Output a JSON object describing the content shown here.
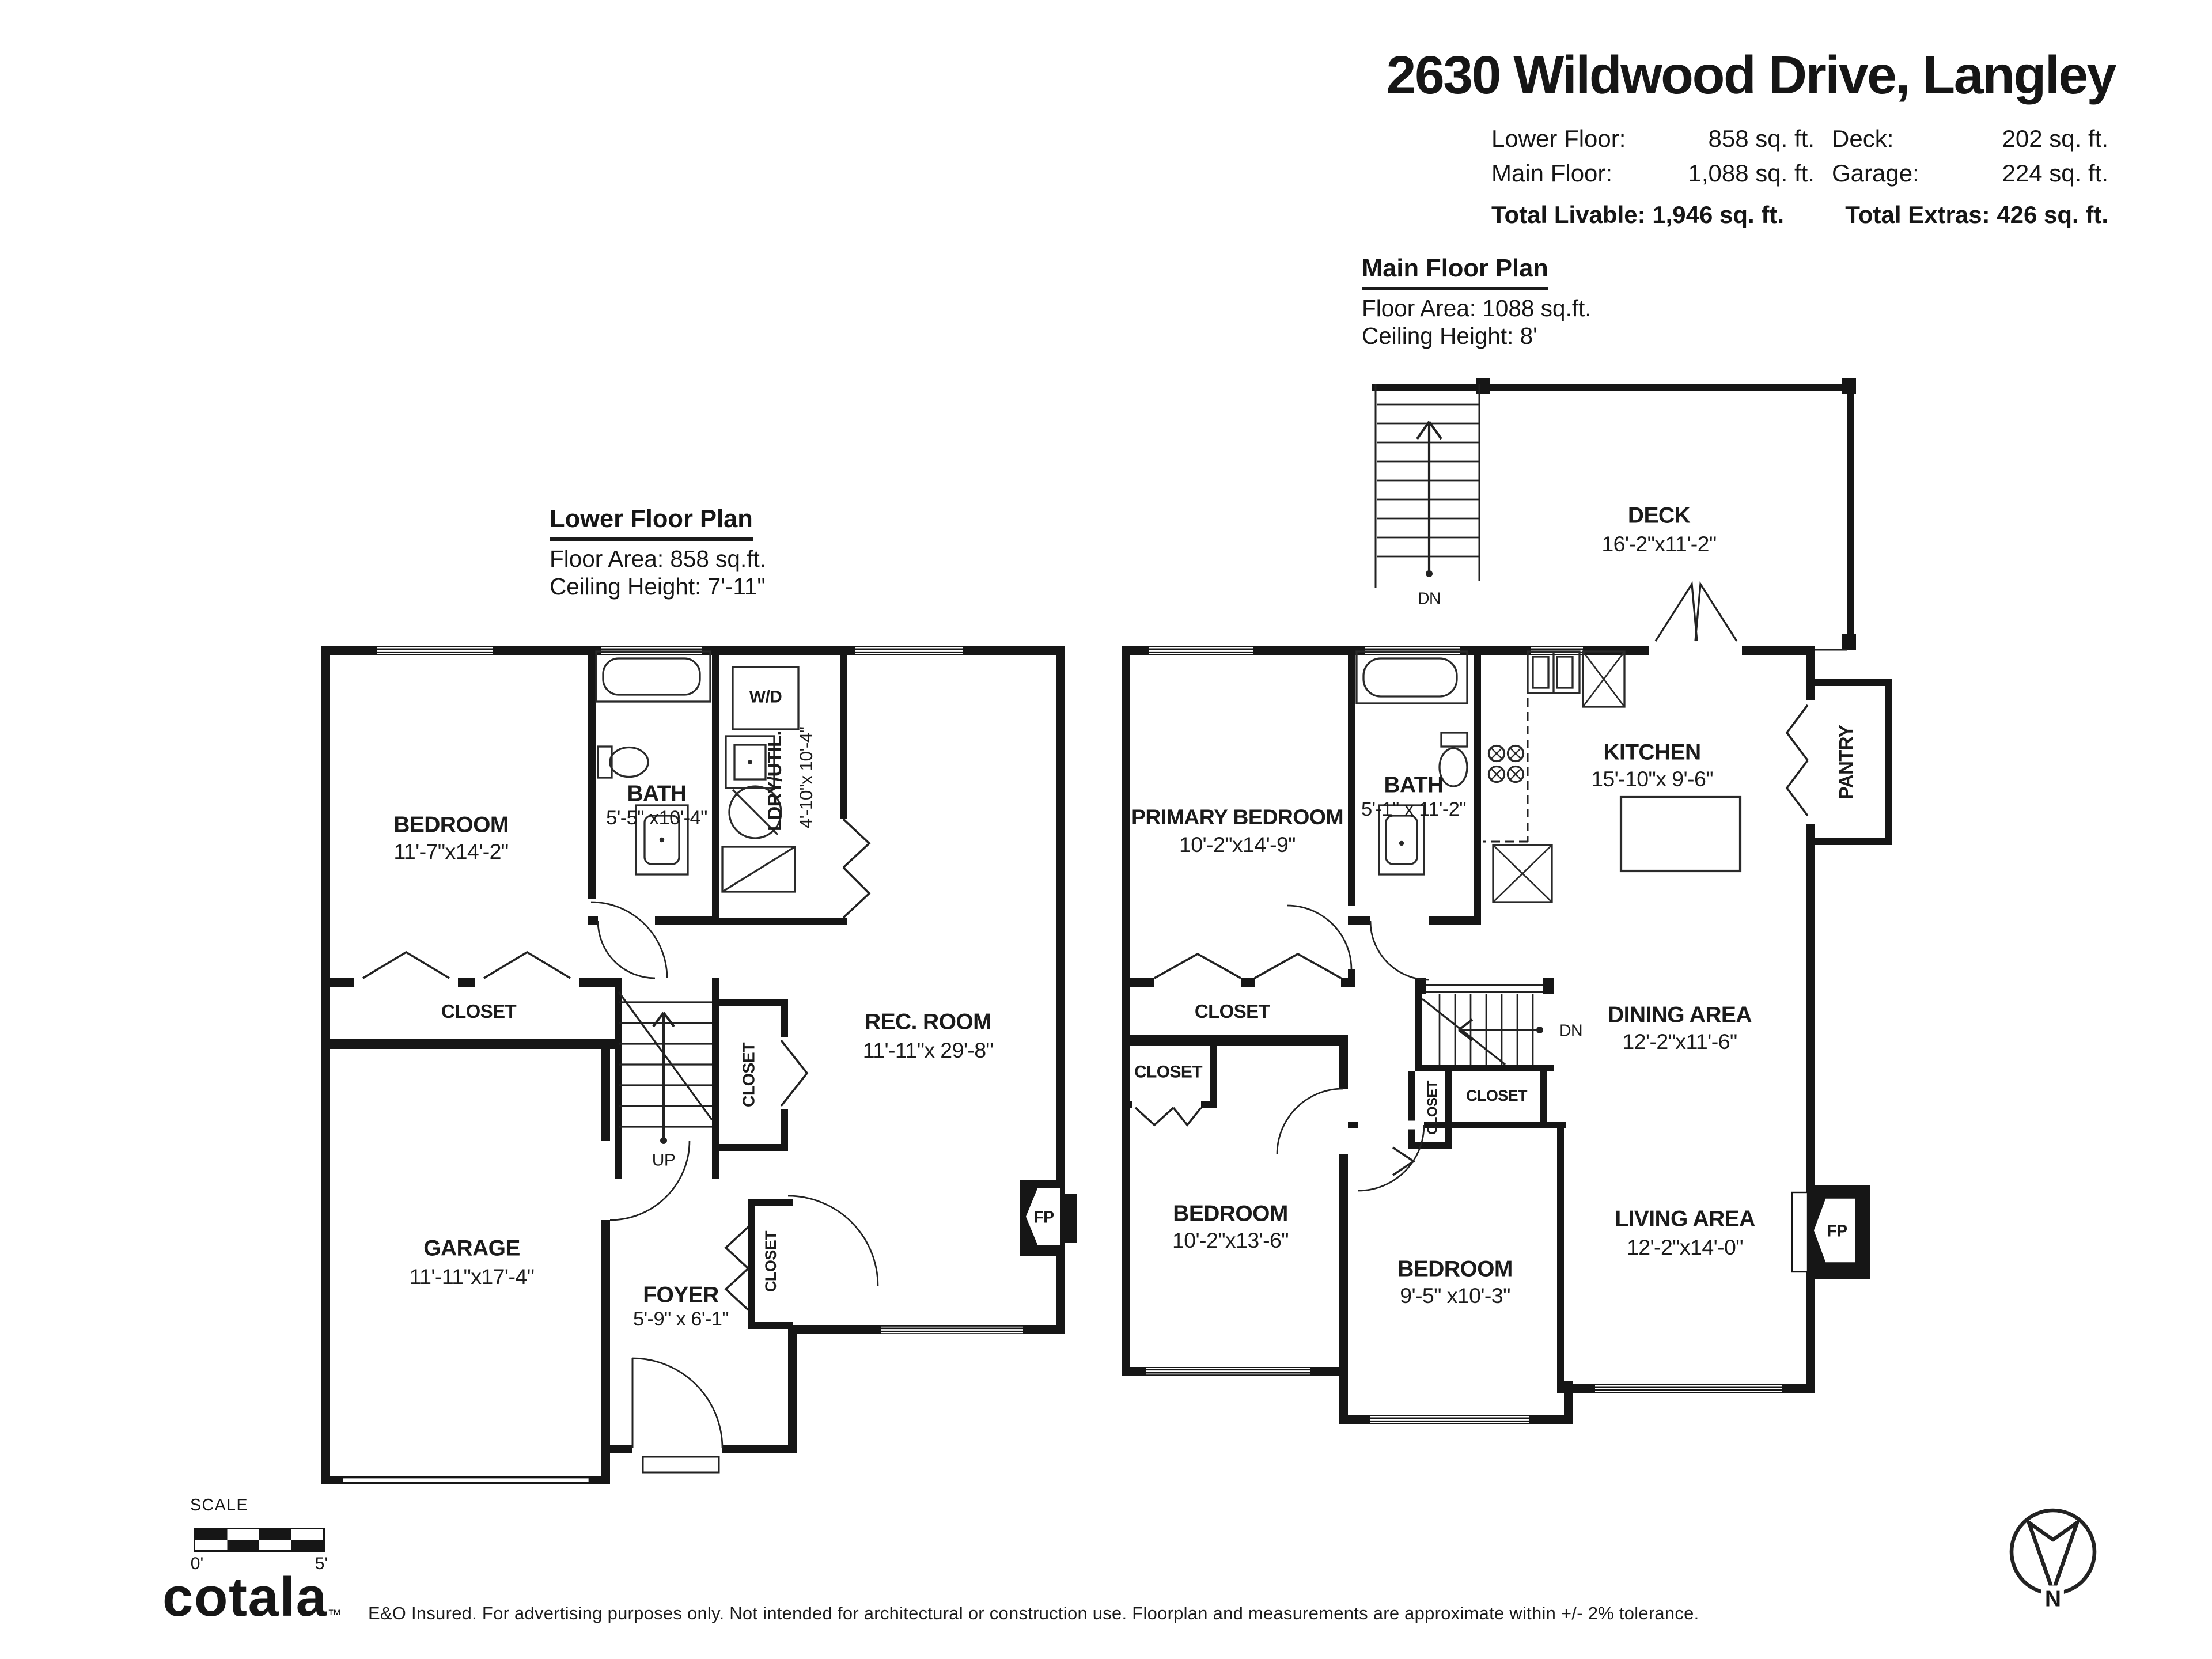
{
  "header": {
    "title": "2630 Wildwood Drive, Langley",
    "lower_floor_label": "Lower Floor:",
    "lower_floor_value": "858 sq. ft.",
    "main_floor_label": "Main Floor:",
    "main_floor_value": "1,088 sq. ft.",
    "deck_label": "Deck:",
    "deck_value": "202 sq. ft.",
    "garage_label": "Garage:",
    "garage_value": "224 sq. ft.",
    "total_livable": "Total Livable: 1,946 sq. ft.",
    "total_extras": "Total Extras: 426 sq. ft."
  },
  "plans": {
    "main": {
      "title": "Main Floor Plan",
      "area": "Floor Area: 1088 sq.ft.",
      "ceiling": "Ceiling Height: 8'"
    },
    "lower": {
      "title": "Lower Floor Plan",
      "area": "Floor Area: 858 sq.ft.",
      "ceiling": "Ceiling Height: 7'-11\""
    }
  },
  "lower_floor": {
    "bedroom": {
      "name": "BEDROOM",
      "dims": "11'-7\"x14'-2\""
    },
    "bath": {
      "name": "BATH",
      "dims": "5'-5\" x10'-4\""
    },
    "laundry": {
      "name": "LDRY/UTIL.",
      "dims": "4'-10\"x 10'-4\""
    },
    "washer_dryer": "W/D",
    "rec_room": {
      "name": "REC. ROOM",
      "dims": "11'-11\"x 29'-8\""
    },
    "closet": "CLOSET",
    "stair_closet": "CLOSET",
    "foyer_closet": "CLOSET",
    "garage": {
      "name": "GARAGE",
      "dims": "11'-11\"x17'-4\""
    },
    "foyer": {
      "name": "FOYER",
      "dims": "5'-9\" x 6'-1\""
    },
    "up": "UP",
    "fireplace": "FP"
  },
  "main_floor": {
    "deck": {
      "name": "DECK",
      "dims": "16'-2\"x11'-2\""
    },
    "deck_down": "DN",
    "primary_bedroom": {
      "name": "PRIMARY BEDROOM",
      "dims": "10'-2\"x14'-9\""
    },
    "bath": {
      "name": "BATH",
      "dims": "5'-1\" x 11'-2\""
    },
    "kitchen": {
      "name": "KITCHEN",
      "dims": "15'-10\"x 9'-6\""
    },
    "pantry": "PANTRY",
    "dining": {
      "name": "DINING AREA",
      "dims": "12'-2\"x11'-6\""
    },
    "down": "DN",
    "primary_closet": "CLOSET",
    "hall_closet": "CLOSET",
    "stair_closet_left": "CLOSET",
    "stair_closet_right": "CLOSET",
    "bedroom_2": {
      "name": "BEDROOM",
      "dims": "10'-2\"x13'-6\""
    },
    "bedroom_3": {
      "name": "BEDROOM",
      "dims": "9'-5\" x10'-3\""
    },
    "living": {
      "name": "LIVING AREA",
      "dims": "12'-2\"x14'-0\""
    },
    "fireplace": "FP"
  },
  "footer": {
    "scale_label": "SCALE",
    "scale_start": "0'",
    "scale_end": "5'",
    "logo": "cotala",
    "logo_tm": "™",
    "disclaimer": "E&O Insured. For advertising purposes only. Not intended for architectural or construction use. Floorplan and measurements are approximate within +/- 2% tolerance.",
    "compass_north": "N"
  }
}
